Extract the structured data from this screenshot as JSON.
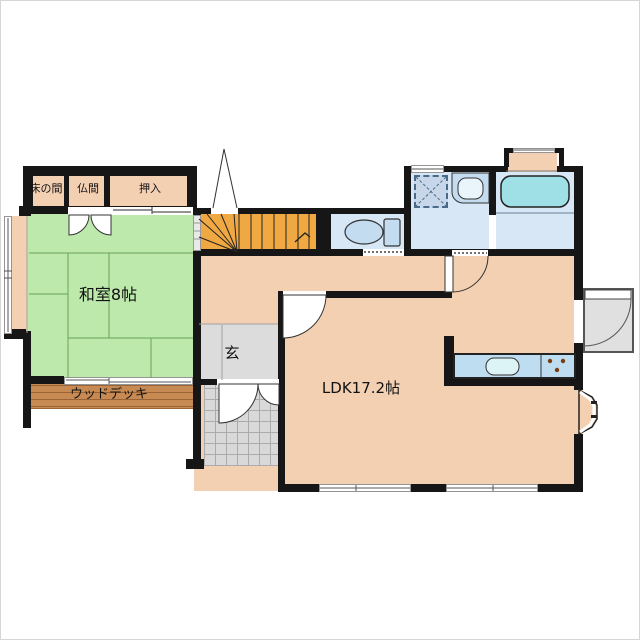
{
  "title": "house-floor-plan-1f",
  "colors": {
    "wall": "#161616",
    "peach": "#F4D0B3",
    "green": "#BDE9AC",
    "blue": "#D7E7F5",
    "cyan": "#9EE0E6",
    "counter": "#BFDDF1",
    "fixture": "#C3DCF0",
    "orange": "#F0A843",
    "deck": "#C68A52",
    "deckline": "#9A6437",
    "gray": "#DCDCDC",
    "tile": "#D9D9D9",
    "tileline": "#ABABAB",
    "platform": "#E0E0E0",
    "tatamiline": "#69A458"
  },
  "rooms": {
    "tokonoma": {
      "label": "床の間"
    },
    "butsuma": {
      "label": "仏間"
    },
    "oshiire": {
      "label": "押入"
    },
    "washitsu": {
      "label": "和室8帖"
    },
    "wood_deck": {
      "label": "ウッドデッキ"
    },
    "genkan": {
      "label": "玄"
    },
    "ldk": {
      "label": "LDK17.2帖"
    }
  },
  "icons": [
    "stairs",
    "up-arrow",
    "toilet",
    "bathtub",
    "washbasin",
    "shower-pan",
    "kitchen-sink",
    "stove-burners",
    "bay-window",
    "tile-porch",
    "door-swing",
    "sliding-window"
  ]
}
